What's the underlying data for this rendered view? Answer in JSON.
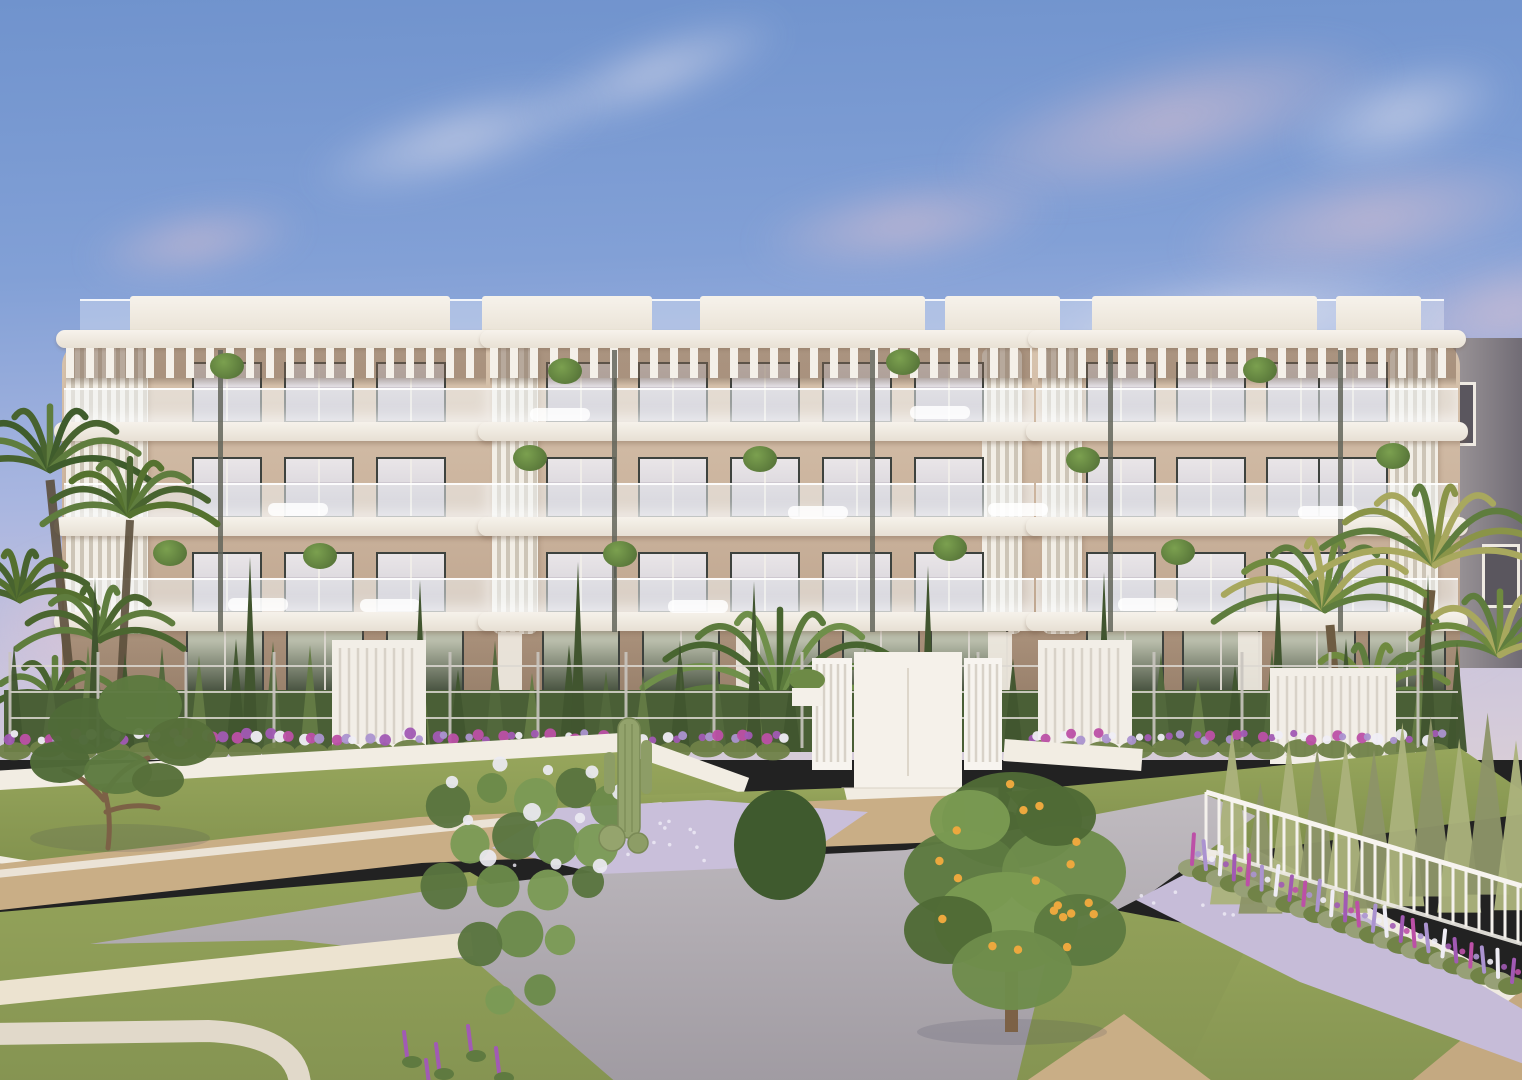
{
  "meta": {
    "title": "New-build apartment complex with landscaped gardens — exterior 3D render",
    "description": "Four-storey cream apartment building with glass balconies and rooftop pergolas above terraced lawns, gravel paths, flower beds, palms and a citrus tree at dusk"
  },
  "palette": {
    "sky_top": "#7093cd",
    "sky_mid": "#82a0d6",
    "sky_low": "#a9b6e0",
    "cloud_pink": "#ecc8d0",
    "cloud_white": "#f3ecf1",
    "facade": "#c9b19b",
    "facade_light": "#d8c4ae",
    "facade_shade": "#b1977f",
    "facade_dusk": "#a28a75",
    "trim": "#f3efe8",
    "trim_shade": "#d9d2c5",
    "glass": "rgba(244,247,249,0.5)",
    "glass_edge": "rgba(255,255,255,0.9)",
    "frame": "#3d423e",
    "pane_hi": "#ded8dc",
    "pane_lo": "#b7b2bf",
    "pane_gf_hi": "#b9bdab",
    "pane_gf_lo": "#47523f",
    "louver_stripe": "#cdc5b7",
    "post": "#63655a",
    "hedge_dark": "#41552f",
    "hedge_mid": "#52683c",
    "hedge_lite": "#647b45",
    "conifer": "#8d9468",
    "conifer_lite": "#abb27c",
    "palm_dark": "#48632f",
    "palm": "#5f7d3e",
    "palm_gold": "#a8a85e",
    "grass": "#8a9a52",
    "grass_dark": "#7e8e4b",
    "grass_lite": "#9aa75d",
    "path_gray": "#b2adb3",
    "path_gray_dk": "#9b969e",
    "gravel_beige": "#c9ae86",
    "cream": "#ece3d0",
    "gravel_lav": "#c9bfda",
    "wall": "#f2ede3",
    "wall_shade": "#cfc8ba",
    "fence": "#dcd8d2",
    "fl_purple": "#a15ab4",
    "fl_magenta": "#bc50a7",
    "fl_lav": "#ab93d0",
    "fl_white": "#efedf5",
    "fl_green": "#6f8148",
    "fruit": "#eca83e",
    "trunk": "#7c6146",
    "bg_pane": "#5a565e"
  },
  "sky": {
    "clouds": [
      {
        "x": 850,
        "y": 30,
        "w": 640,
        "h": 180,
        "rot": -14,
        "type": "pink"
      },
      {
        "x": 1100,
        "y": 140,
        "w": 540,
        "h": 160,
        "rot": -10,
        "type": "pink"
      },
      {
        "x": 1240,
        "y": 50,
        "w": 320,
        "h": 130,
        "rot": -18,
        "type": "white"
      },
      {
        "x": 690,
        "y": 165,
        "w": 430,
        "h": 120,
        "rot": -8,
        "type": "pink"
      },
      {
        "x": 1320,
        "y": 235,
        "w": 380,
        "h": 150,
        "rot": -12,
        "type": "pink"
      },
      {
        "x": 240,
        "y": 85,
        "w": 430,
        "h": 110,
        "rot": -16,
        "type": "white"
      },
      {
        "x": 40,
        "y": 195,
        "w": 310,
        "h": 95,
        "rot": -10,
        "type": "pink"
      },
      {
        "x": 950,
        "y": 255,
        "w": 580,
        "h": 120,
        "rot": -6,
        "type": "white"
      },
      {
        "x": 460,
        "y": 25,
        "w": 390,
        "h": 95,
        "rot": -20,
        "type": "white"
      },
      {
        "x": -60,
        "y": 520,
        "w": 300,
        "h": 210,
        "rot": 0,
        "type": "pink"
      },
      {
        "x": 1290,
        "y": 530,
        "w": 260,
        "h": 170,
        "rot": 0,
        "type": "pink"
      }
    ]
  },
  "background_building": {
    "x": 1396,
    "y": 338,
    "w": 126,
    "h": 330,
    "windows": [
      {
        "x": 1430,
        "y": 382,
        "w": 40,
        "h": 58
      },
      {
        "x": 1482,
        "y": 544,
        "w": 32,
        "h": 58
      }
    ]
  },
  "building": {
    "x": 62,
    "w": 1398,
    "top": 296,
    "roof_glass": {
      "x": 80,
      "y": 299,
      "w": 1364,
      "h": 34
    },
    "roof_boxes": [
      {
        "x": 130,
        "w": 320
      },
      {
        "x": 482,
        "w": 170
      },
      {
        "x": 700,
        "w": 225
      },
      {
        "x": 945,
        "w": 115
      },
      {
        "x": 1092,
        "w": 225
      },
      {
        "x": 1336,
        "w": 85
      }
    ],
    "modules": [
      {
        "x": 62,
        "w": 428
      },
      {
        "x": 486,
        "w": 550
      },
      {
        "x": 1034,
        "w": 426
      }
    ],
    "floors": {
      "count": 3,
      "first_glass_top": 388,
      "pitch": 95,
      "glass_h": 36,
      "slab_h": 19,
      "win_h": 57,
      "win_offset": 26
    },
    "window_cols": [
      192,
      284,
      376,
      546,
      638,
      730,
      822,
      914,
      1086,
      1176,
      1266,
      1318
    ],
    "window_w": 66,
    "gf": {
      "y": 628,
      "h": 112,
      "cols": [
        186,
        286,
        386,
        542,
        642,
        742,
        842,
        930,
        1086,
        1182,
        1278,
        1368
      ],
      "w": 74,
      "dividers": [
        498,
        736,
        988,
        1238
      ]
    },
    "louvers": [
      {
        "x": 66,
        "w": 82
      },
      {
        "x": 492,
        "w": 46
      },
      {
        "x": 982,
        "w": 40
      },
      {
        "x": 1042,
        "w": 40
      },
      {
        "x": 1390,
        "w": 48
      }
    ],
    "posts": [
      218,
      612,
      870,
      1108,
      1338
    ],
    "plants": [
      [
        565,
        370
      ],
      [
        903,
        361
      ],
      [
        1260,
        369
      ],
      [
        227,
        365
      ],
      [
        530,
        457
      ],
      [
        1083,
        459
      ],
      [
        1393,
        455
      ],
      [
        170,
        552
      ],
      [
        620,
        553
      ],
      [
        950,
        547
      ],
      [
        1178,
        551
      ],
      [
        320,
        555
      ],
      [
        760,
        458
      ]
    ],
    "furniture": [
      [
        298,
        503
      ],
      [
        818,
        506
      ],
      [
        1018,
        503
      ],
      [
        258,
        598
      ],
      [
        698,
        600
      ],
      [
        1148,
        598
      ],
      [
        1328,
        506
      ],
      [
        390,
        599
      ],
      [
        560,
        408
      ],
      [
        940,
        406
      ]
    ]
  },
  "hedge": {
    "base_y": 752,
    "x0": 4,
    "x1": 1456,
    "spacing": 37,
    "h_min": 74,
    "h_var": 40,
    "tall": [
      95,
      250,
      420,
      578,
      754,
      928,
      1104,
      1278,
      1428
    ],
    "tall_h": 168
  },
  "fence": {
    "x0": 10,
    "x1": 1458,
    "spacing": 88,
    "top": 652,
    "bottom": 748,
    "rails": [
      666,
      692,
      718
    ]
  },
  "pillars": [
    {
      "x": 332,
      "w": 94,
      "y": 640,
      "h": 112
    },
    {
      "x": 1038,
      "w": 94,
      "y": 640,
      "h": 112
    },
    {
      "x": 1270,
      "w": 126,
      "y": 668,
      "h": 96
    }
  ],
  "gate": {
    "slat_l": {
      "x": 812,
      "w": 40
    },
    "center": {
      "x": 854,
      "w": 108
    },
    "slat_r": {
      "x": 964,
      "w": 38
    },
    "top": 658,
    "bottom": 788,
    "steps": {
      "x": 842,
      "w": 156,
      "ys": [
        788,
        803,
        817
      ],
      "h": 15
    },
    "planter": {
      "x": 792,
      "y": 688,
      "w": 30,
      "h": 18
    }
  },
  "flower_strip": {
    "y": 736,
    "x0": 14,
    "x1": 1448,
    "spacing": 33,
    "skip": [
      796,
      1016
    ],
    "colors": [
      "purple",
      "white",
      "magenta",
      "lavender",
      "white",
      "purple",
      "lavender",
      "magenta"
    ]
  },
  "right_bed": {
    "x0": 1192,
    "y0": 868,
    "x1": 1512,
    "y1": 986,
    "count": 24
  },
  "railing": {
    "x0": 1206,
    "y0": 792,
    "x1": 1522,
    "y1": 886,
    "h": 58,
    "gap": 13
  },
  "citrus": {
    "cx": 1012,
    "cy": 885,
    "rx": 108,
    "ry": 112,
    "fruits": 30
  },
  "conifers_right": {
    "x0": 1232,
    "x1": 1516,
    "count": 11
  },
  "bottom_flowers": [
    [
      408,
      1048
    ],
    [
      440,
      1060
    ],
    [
      472,
      1042
    ],
    [
      500,
      1064
    ],
    [
      430,
      1076
    ]
  ]
}
